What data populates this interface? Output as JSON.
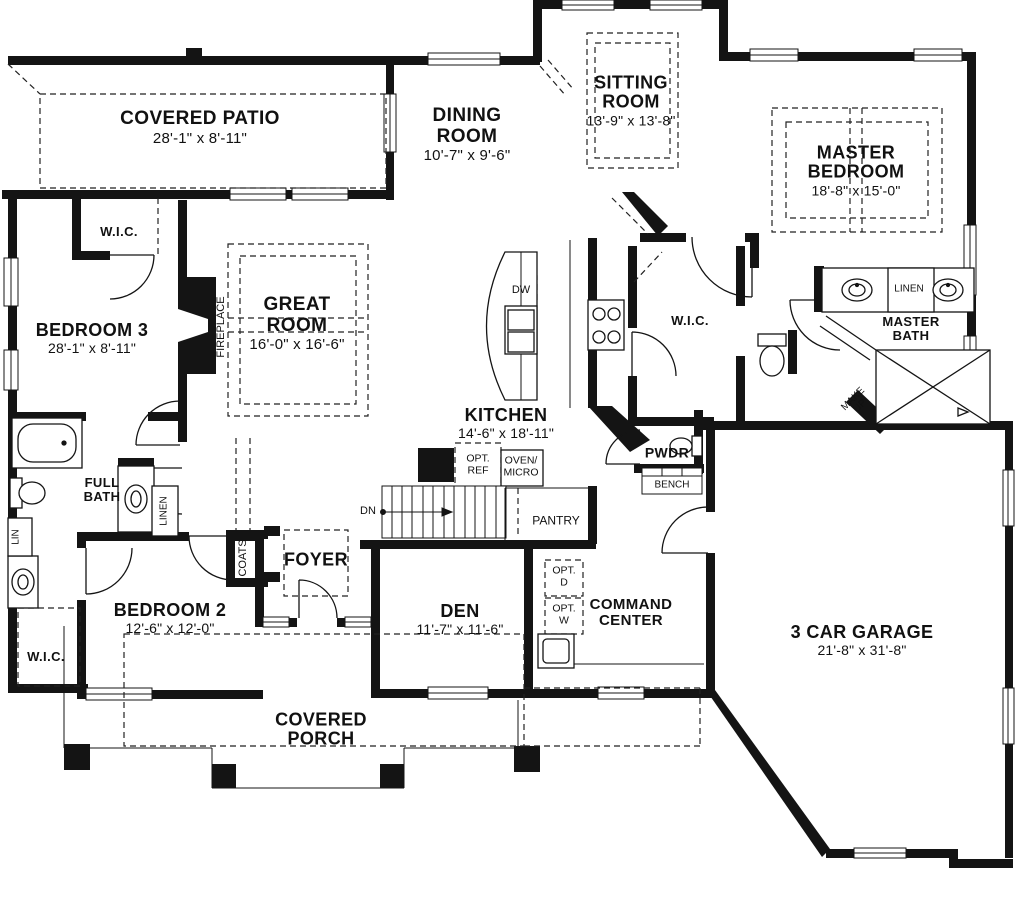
{
  "labels": {
    "covered_patio": {
      "name": "COVERED PATIO",
      "dims": "28'-1\" x 8'-11\""
    },
    "dining_room": {
      "name": "DINING ROOM",
      "dims": "10'-7\" x 9'-6\""
    },
    "sitting_room": {
      "name": "SITTING ROOM",
      "dims": "13'-9\" x 13'-8\""
    },
    "master_bedroom": {
      "name": "MASTER BEDROOM",
      "dims": "18'-8\" x 15'-0\""
    },
    "bedroom_3": {
      "name": "BEDROOM 3",
      "dims": "28'-1\" x 8'-11\""
    },
    "great_room": {
      "name": "GREAT ROOM",
      "dims": "16'-0\" x 16'-6\""
    },
    "kitchen": {
      "name": "KITCHEN",
      "dims": "14'-6\" x 18'-11\""
    },
    "bedroom_2": {
      "name": "BEDROOM 2",
      "dims": "12'-6\" x 12'-0\""
    },
    "den": {
      "name": "DEN",
      "dims": "11'-7\" x 11'-6\""
    },
    "garage": {
      "name": "3 CAR GARAGE",
      "dims": "21'-8\" x 31'-8\""
    },
    "covered_porch": {
      "name": "COVERED PORCH"
    },
    "foyer": {
      "name": "FOYER"
    },
    "command_center": {
      "name": "COMMAND CENTER"
    },
    "master_bath": {
      "name": "MASTER BATH"
    },
    "full_bath": {
      "name": "FULL BATH"
    },
    "pantry": {
      "name": "PANTRY"
    },
    "pwdr": {
      "name": "PWDR"
    },
    "bench": {
      "name": "BENCH"
    },
    "wic_bedroom3": {
      "name": "W.I.C."
    },
    "wic_master": {
      "name": "W.I.C."
    },
    "wic_bedroom2": {
      "name": "W.I.C."
    },
    "linen_master": {
      "name": "LINEN"
    },
    "linen_bath": {
      "name": "LINEN"
    },
    "lin": {
      "name": "LIN"
    },
    "coats": {
      "name": "COATS"
    },
    "fireplace": {
      "name": "FIREPLACE"
    },
    "dn": {
      "name": "DN"
    },
    "dw": {
      "name": "DW"
    },
    "make_up": {
      "line1": "MAKE",
      "line2": "UP"
    },
    "opt_ref": {
      "line1": "OPT.",
      "line2": "REF"
    },
    "oven_micro": {
      "line1": "OVEN/",
      "line2": "MICRO"
    },
    "opt_d": {
      "line1": "OPT.",
      "line2": "D"
    },
    "opt_w": {
      "line1": "OPT.",
      "line2": "W"
    }
  }
}
